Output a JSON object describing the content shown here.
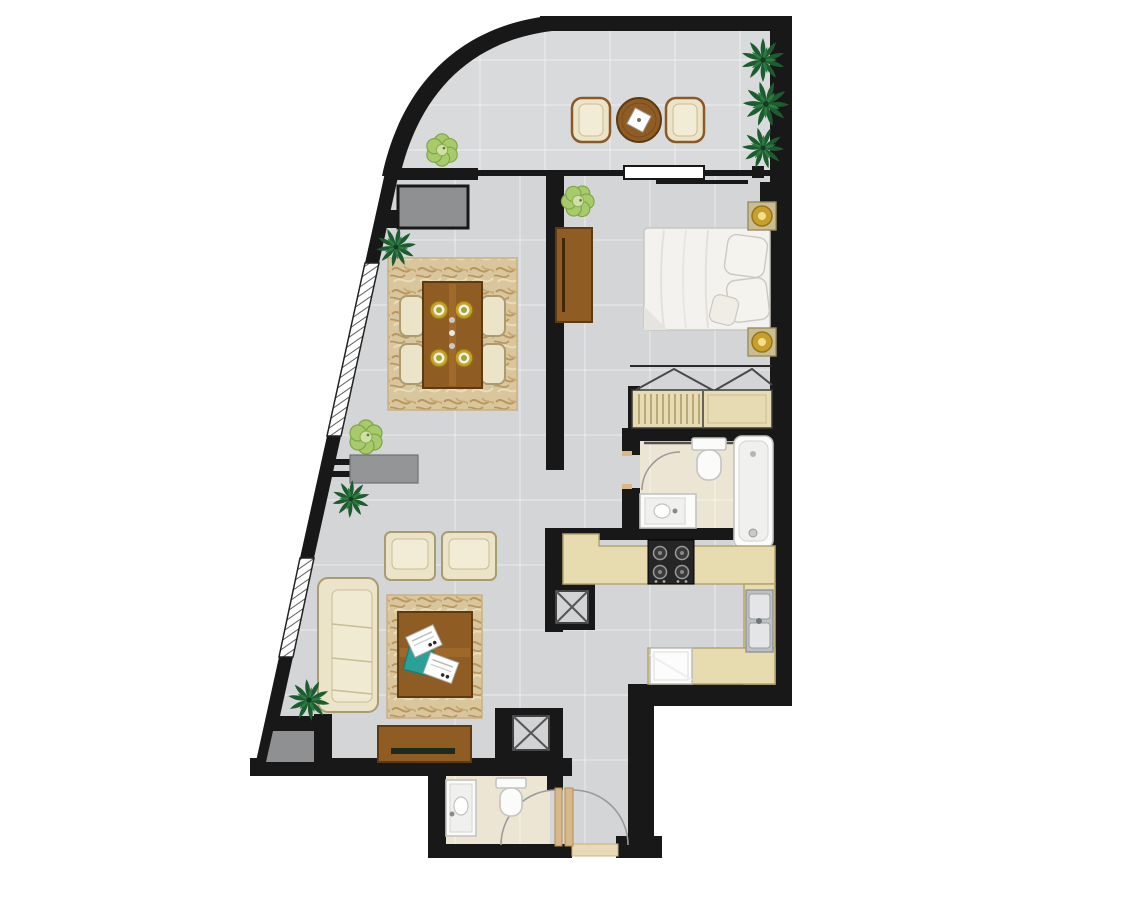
{
  "document": {
    "kind": "apartment-floor-plan",
    "style": "top-down 2D colour render, unlabelled (no text in image)",
    "orientation": "curved glass facade and balcony at top, angled window wall on left, entrance at bottom"
  },
  "palette": {
    "wall": "#181818",
    "floor_main": "#d4d5d7",
    "floor_balcony": "#d9dadc",
    "floor_bath": "#ece5d4",
    "rug_base": "#d9c69c",
    "rug_scribble": "#b8965f",
    "wood": "#8f5c24",
    "wood_dark": "#5d3a12",
    "cream": "#ece4c9",
    "counter": "#e7dcb0",
    "stove": "#262626",
    "steel": "#bcc0c2",
    "gold": "#c8a029",
    "teal": "#2aa198",
    "plant_dark": "#1d5c2f",
    "plant_light": "#a7ca6b",
    "shelf_gray": "#939597",
    "alcove_gray": "#8e9092",
    "door_tan": "#d8b888",
    "fixture_white": "#fbfbfa",
    "hatch_line": "#4c4c4c",
    "tile_line": "#ffffff"
  },
  "rooms": [
    {
      "name": "balcony",
      "shape": "curved wedge along top",
      "items": [
        "round-bistro-table",
        "bistro-chair-left",
        "bistro-chair-right",
        "napkin",
        "palm-plant x3 (right edge)",
        "shrub-plant (left end)"
      ]
    },
    {
      "name": "living-dining",
      "shape": "large room behind angled window wall",
      "items": [
        "dining-rug",
        "dining-table",
        "dining-chair x4",
        "place-setting x4",
        "wall-shelf-console",
        "armchair x2",
        "sofa",
        "living-rug",
        "coffee-table",
        "magazine x2",
        "teal-tray",
        "tv-cabinet",
        "dark-plant x3",
        "light-plant x1"
      ]
    },
    {
      "name": "bedroom",
      "shape": "top right",
      "items": [
        "double-bed",
        "pillow x3",
        "nightstand x2",
        "table-lamp x2",
        "dresser",
        "light-plant",
        "closet-hanging-zigzag",
        "wardrobe (slatted + plain doors)"
      ]
    },
    {
      "name": "bathroom",
      "shape": "right of hallway",
      "items": [
        "bathtub",
        "toilet",
        "vanity-sink",
        "shower-bar",
        "door-swing-arc"
      ]
    },
    {
      "name": "kitchen",
      "shape": "U of counters lower right",
      "items": [
        "counter-top-run",
        "stove-4-burner",
        "counter-right-run",
        "double-steel-sink",
        "counter-bottom-run",
        "refrigerator",
        "service-shaft-x"
      ]
    },
    {
      "name": "entry-corridor",
      "shape": "bottom right strip",
      "items": [
        "entrance-door-leaf",
        "entrance-door-arc",
        "threshold",
        "service-shaft-x"
      ]
    },
    {
      "name": "powder-room",
      "shape": "bottom centre bump-out",
      "items": [
        "vanity-sink",
        "toilet",
        "door-leaf",
        "door-swing-arc"
      ]
    }
  ],
  "features": {
    "windows_hatched_on_angled_wall": 2,
    "balcony_sliding_door": 1,
    "exterior_planter_alcove_top_left": 1,
    "exterior_gray_alcove_bottom_left": 1,
    "service_shafts": 2
  }
}
